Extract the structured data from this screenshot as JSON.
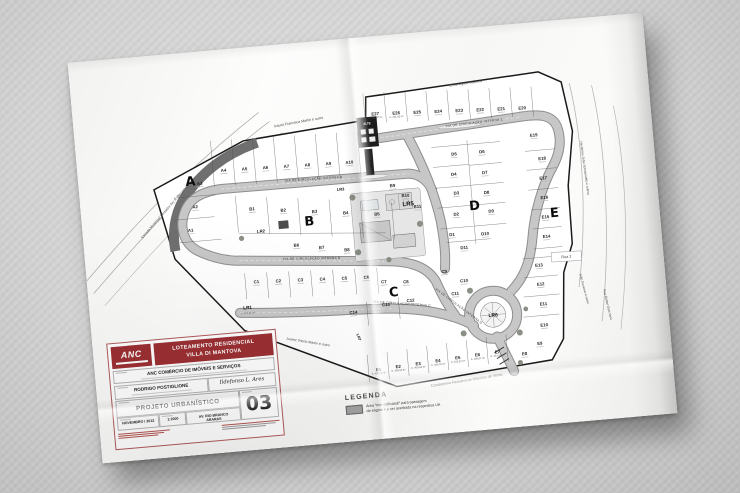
{
  "plan": {
    "block_letters": [
      "A",
      "B",
      "C",
      "D",
      "E"
    ],
    "lots": {
      "A": [
        "A1",
        "A2",
        "A3",
        "A4",
        "A5",
        "A6",
        "A7",
        "A8",
        "A9",
        "A10"
      ],
      "B": [
        "B1",
        "B2",
        "B3",
        "B4",
        "B5",
        "B6",
        "B7",
        "B8",
        "B9",
        "B10",
        "B11"
      ],
      "C": [
        "C1",
        "C2",
        "C3",
        "C4",
        "C5",
        "C6",
        "C7",
        "C8",
        "C9",
        "C10",
        "C11",
        "C12",
        "C13",
        "C14"
      ],
      "D": [
        "D1",
        "D2",
        "D3",
        "D4",
        "D5",
        "D6",
        "D7",
        "D8",
        "D9",
        "D10",
        "D11"
      ],
      "E": [
        "E1",
        "E2",
        "E3",
        "E4",
        "E5",
        "E6",
        "E7",
        "E8",
        "E9",
        "E10",
        "E11",
        "E12",
        "E13",
        "E14",
        "E15",
        "E16",
        "E17",
        "E18",
        "E19",
        "E20",
        "E21",
        "E22",
        "E23",
        "E24",
        "E25",
        "E26",
        "E27"
      ]
    },
    "areas": {
      "E1": "A. 400,38 m²",
      "E2": "A. 400,53 m²",
      "E3": "A. 400,63 m²",
      "E4": "A. 400,76 m²",
      "E5": "A. 402,53 m²",
      "E6": "A. 409,07 m²",
      "E7": "A. 414,50 m²",
      "E26": "A. 401,03 m²",
      "E27": "A. 402,37 m²"
    },
    "leisure_ids": [
      "LR1",
      "LR2",
      "LR3",
      "LR4",
      "LR5",
      "LR6",
      "LR7"
    ],
    "lr1_area": "A. 471,11 m²",
    "utility_label": "SLTE",
    "streets_internal": [
      "VIA DE CIRCULAÇÃO INTERNA A",
      "VIA DE CIRCULAÇÃO INTERNA B",
      "VIA DE CIRCULAÇÃO INTERNA C",
      "VIA DE CIRCULAÇÃO INTERNA D",
      "VIA DE CIRCULAÇÃO INTERNA E"
    ],
    "streets_external": [
      "Izaura Francisca Martin e outro",
      "Ermenegildo Gazinelli",
      "Estrada Municipal Vereador Ary A. Bergamo",
      "Herdeiros João Schiavinatto e outros",
      "Rua 2",
      "João Davanso e outro",
      "Rua Rafael Galo Tone",
      "Juarez Vitorio Martin e outro",
      "Condomínio Residencial Moinhos de Vento"
    ]
  },
  "legend": {
    "title": "LEGENDA",
    "swatch_color": "#a2a2a2",
    "item_line1": "Área \"non edificandi\" para passagem",
    "item_line2": "de esgoto e a ser averbada na respectiva UA"
  },
  "title_block": {
    "logo_text": "ANC",
    "banner_line1": "LOTEAMENTO RESIDENCIAL",
    "banner_line2": "VILLA DI MANTOVA",
    "owner": "ANC COMÉRCIO DE IMÓVEIS E SERVIÇOS",
    "author": "RODRIGO POSTIGLIONE",
    "signature": "Ildefonso L. Ares",
    "project": "PROJETO URBANÍSTICO",
    "sheet_number": "03",
    "date": "NOVEMBRO / 2012",
    "scale": "1:1000",
    "address_line1": "AV. RIO BRANCO",
    "address_line2": "ARARAS"
  }
}
